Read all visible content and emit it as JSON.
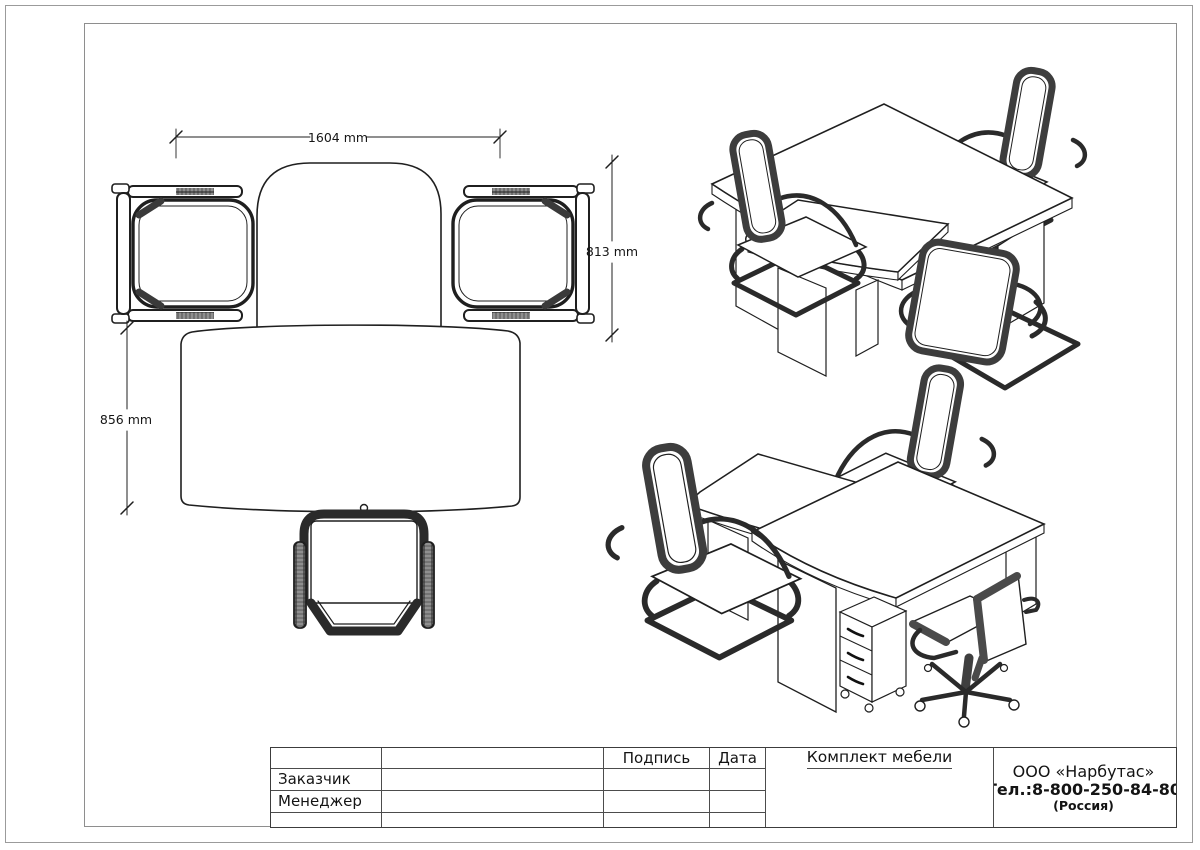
{
  "page": {
    "background": "#ffffff",
    "line_color": "#1f1f1f",
    "frame_color": "#8e8e8e",
    "chair_band_color": "#3d3d3d"
  },
  "plan_view": {
    "dim_width": "1604 mm",
    "dim_side_depth": "813 mm",
    "dim_front_depth": "856 mm"
  },
  "title_block": {
    "signature_header": "Подпись",
    "date_header": "Дата",
    "customer_label": "Заказчик",
    "manager_label": "Менеджер",
    "project_title": "Комплект мебели",
    "company_name": "ООО «Нарбутас»",
    "company_phone": "Тел.:8-800-250-84-80",
    "company_country": "(Россия)"
  }
}
